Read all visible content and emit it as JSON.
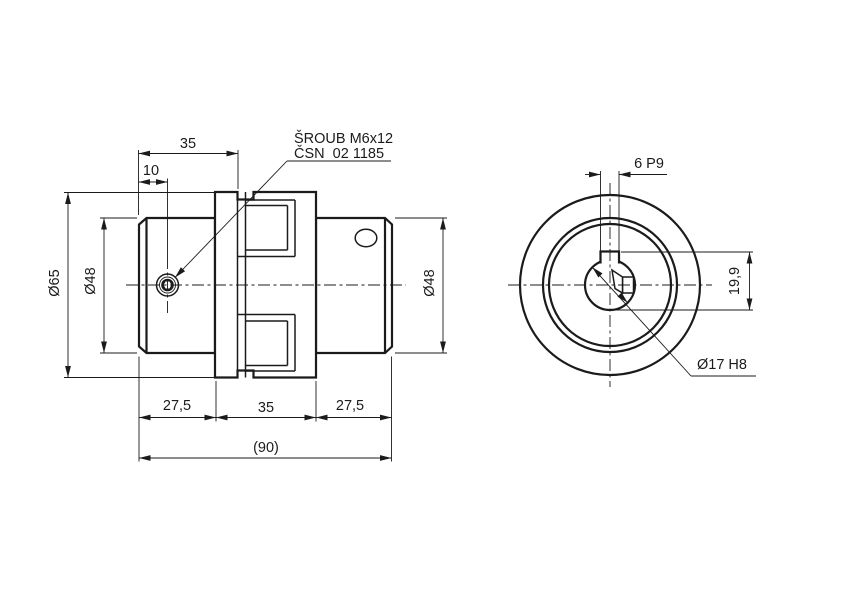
{
  "colors": {
    "background": "#ffffff",
    "line": "#1b1b1b"
  },
  "side_view": {
    "dims": {
      "top_35": "35",
      "top_10": "10",
      "dia_65": "Ø65",
      "dia_48_left": "Ø48",
      "dia_48_right": "Ø48",
      "bottom_27_5_left": "27,5",
      "bottom_35": "35",
      "bottom_27_5_right": "27,5",
      "overall_90": "(90)"
    },
    "screw_note": {
      "line1": "ŠROUB M6x12",
      "line2": "ČSN  02 1185"
    }
  },
  "end_view": {
    "dims": {
      "keyway_width": "6 P9",
      "keyway_depth": "19,9",
      "bore": "Ø17 H8"
    }
  }
}
